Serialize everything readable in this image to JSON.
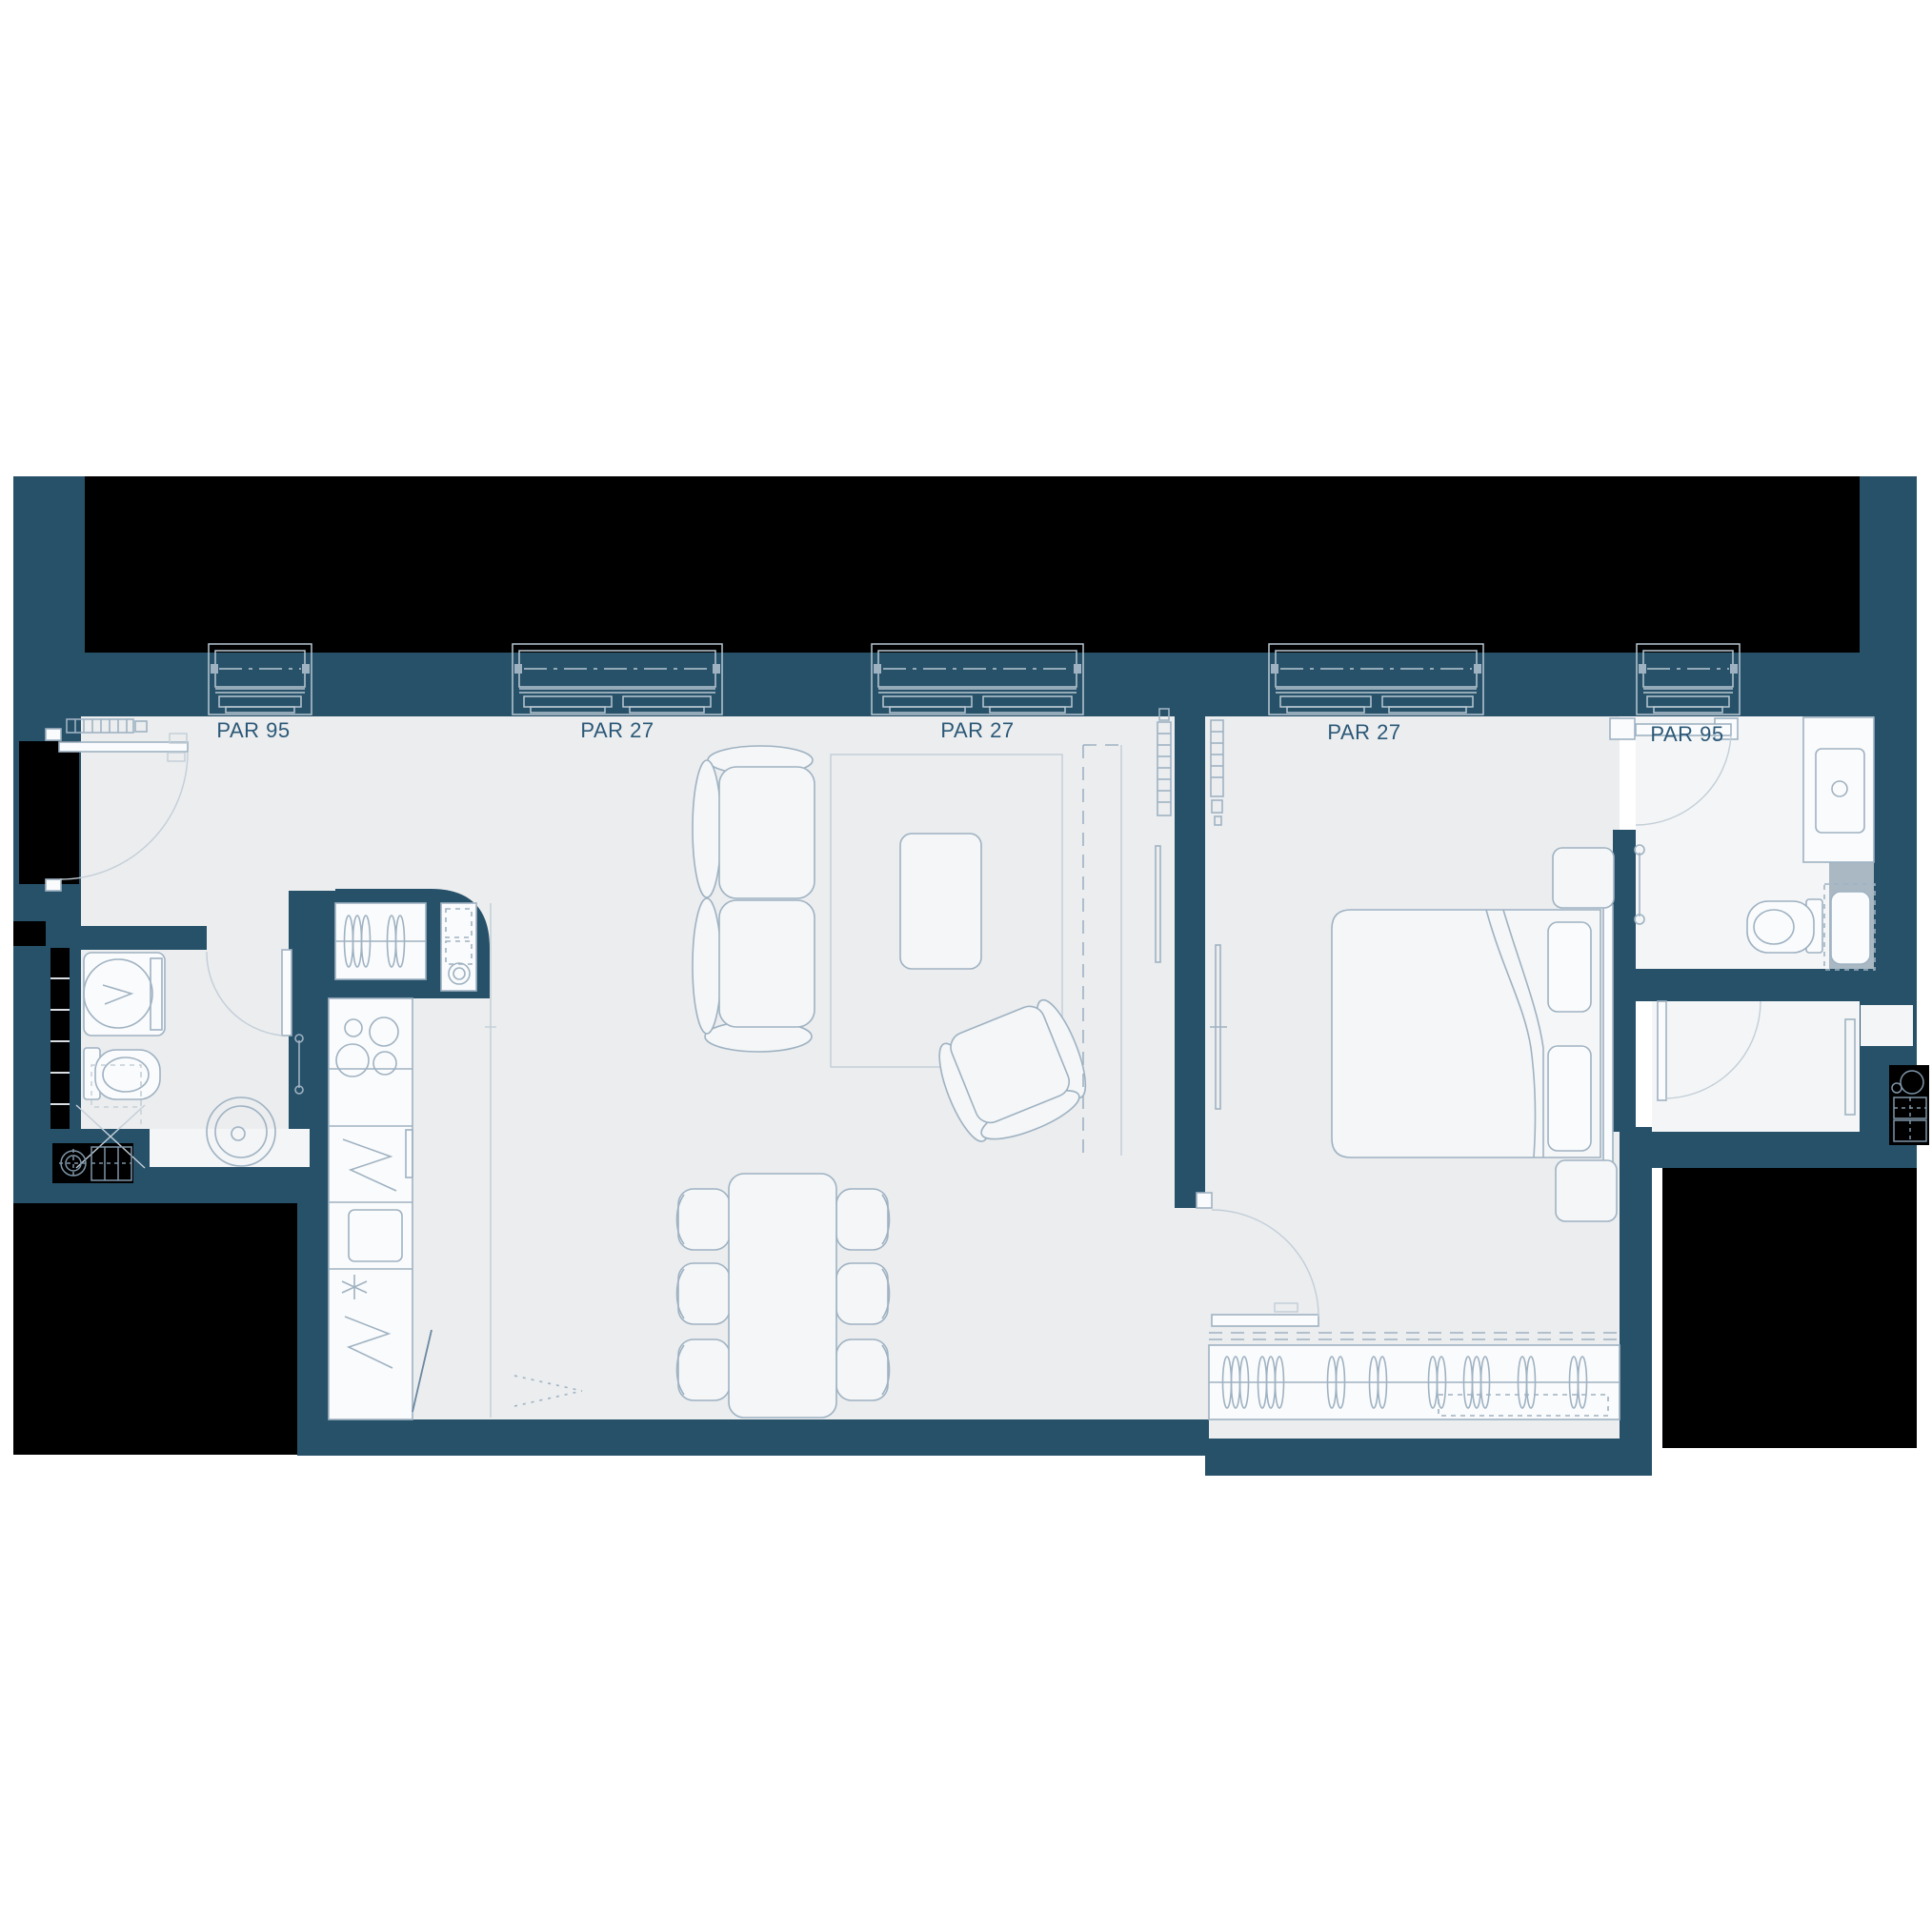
{
  "plan": {
    "type": "apartment-floor-plan",
    "window_labels": [
      {
        "id": "window-1",
        "text": "PAR 95"
      },
      {
        "id": "window-2",
        "text": "PAR 27"
      },
      {
        "id": "window-3",
        "text": "PAR 27"
      },
      {
        "id": "window-4",
        "text": "PAR 27"
      },
      {
        "id": "window-5",
        "text": "PAR 95"
      }
    ],
    "colors": {
      "wall": "#275169",
      "void": "#000000",
      "floor": "#ebedef",
      "floor_bath": "#f3f5f6",
      "shower": "#a9b8c3",
      "white": "#fafbfc",
      "furniture_fill": "#f4f6f7",
      "line": "#9fb2c2",
      "line_light": "#c3ced8",
      "line_dark": "#6c88a0",
      "line_win": "#b9c7d2",
      "label": "#2b5877"
    }
  }
}
